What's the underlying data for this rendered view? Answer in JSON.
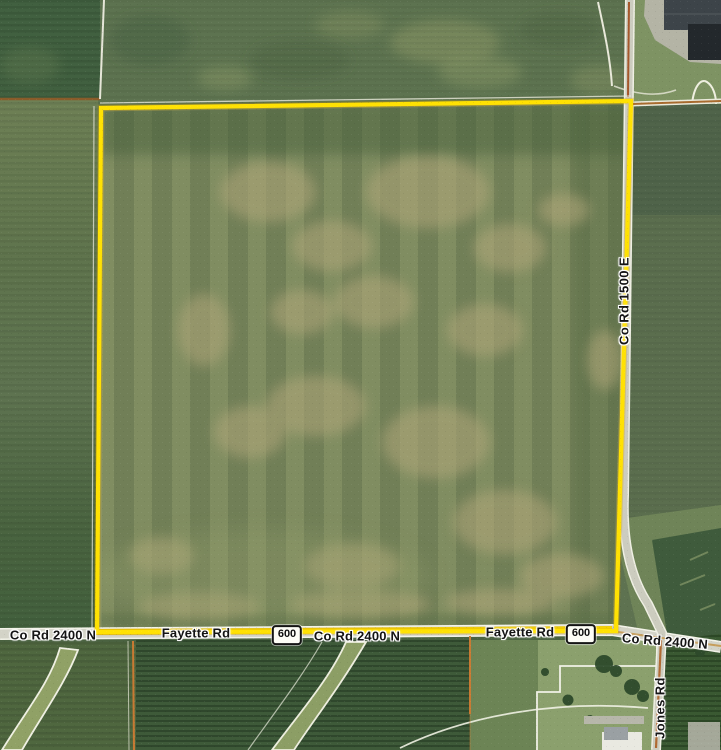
{
  "map": {
    "description": "Aerial parcel map of a farm field outlined in yellow at the corner of Fayette Rd / Co Rd 2400 N and Co Rd 1500 E",
    "road_labels": {
      "co_rd_2400n_left": "Co Rd 2400 N",
      "fayette_rd_left": "Fayette Rd",
      "co_rd_2400n_mid": "Co Rd 2400 N",
      "fayette_rd_right": "Fayette Rd",
      "co_rd_2400n_right": "Co Rd 2400 N",
      "co_rd_1500e": "Co Rd 1500 E",
      "jones_rd": "Jones Rd"
    },
    "route_shields": {
      "left": "600",
      "right": "600"
    },
    "colors": {
      "parcel_boundary": "#FFE103",
      "road_highlight": "#F0CC0C",
      "shield_border": "#141414",
      "label_text": "#141414",
      "label_halo": "#FFFFFF"
    }
  }
}
